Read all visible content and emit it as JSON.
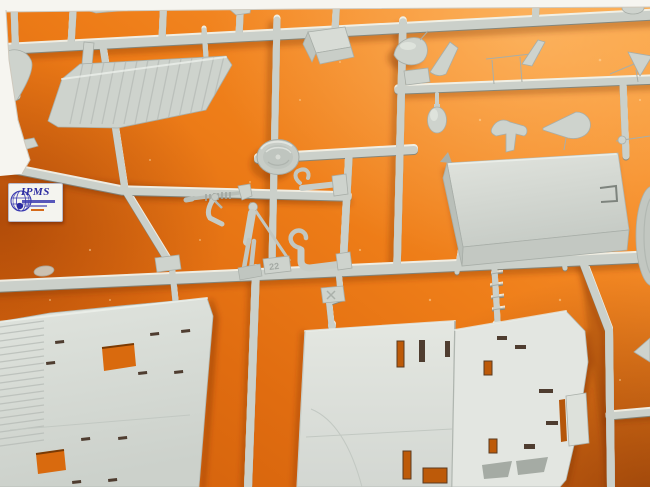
{
  "scene": {
    "type": "photograph",
    "subject": "Injection-molded model kit sprue of light grey styrene parts lying on orange foam",
    "width": 650,
    "height": 487
  },
  "colors": {
    "background_orange": "#ee7d18",
    "background_shadow": "#b5560a",
    "plastic_grey": "#cdd2cc",
    "plastic_highlight": "#eef1ec",
    "photo_border_white": "#f6f5f0",
    "logo_blue": "#2b2ba0",
    "logo_accent_orange": "#d56a1a"
  },
  "watermark": {
    "title": "IPMS"
  },
  "molded_marks": {
    "part_number": "22"
  },
  "parts_visible": [
    "ribbed wing panel (upper left)",
    "small tail fin",
    "pilot seat",
    "bomb / drop tank",
    "spinner cone",
    "rack bracket",
    "arrow vane",
    "teardrop tank",
    "saddle bracket",
    "nose cone",
    "large cabin roof panel",
    "road wheel (right edge)",
    "wheel disc",
    "machine gun",
    "standing pilot figure",
    "figure arm",
    "exhaust hook pipes",
    "part number tags",
    "lower wing half left",
    "lower wing half center",
    "lower wing half right",
    "sprue runner frame"
  ]
}
